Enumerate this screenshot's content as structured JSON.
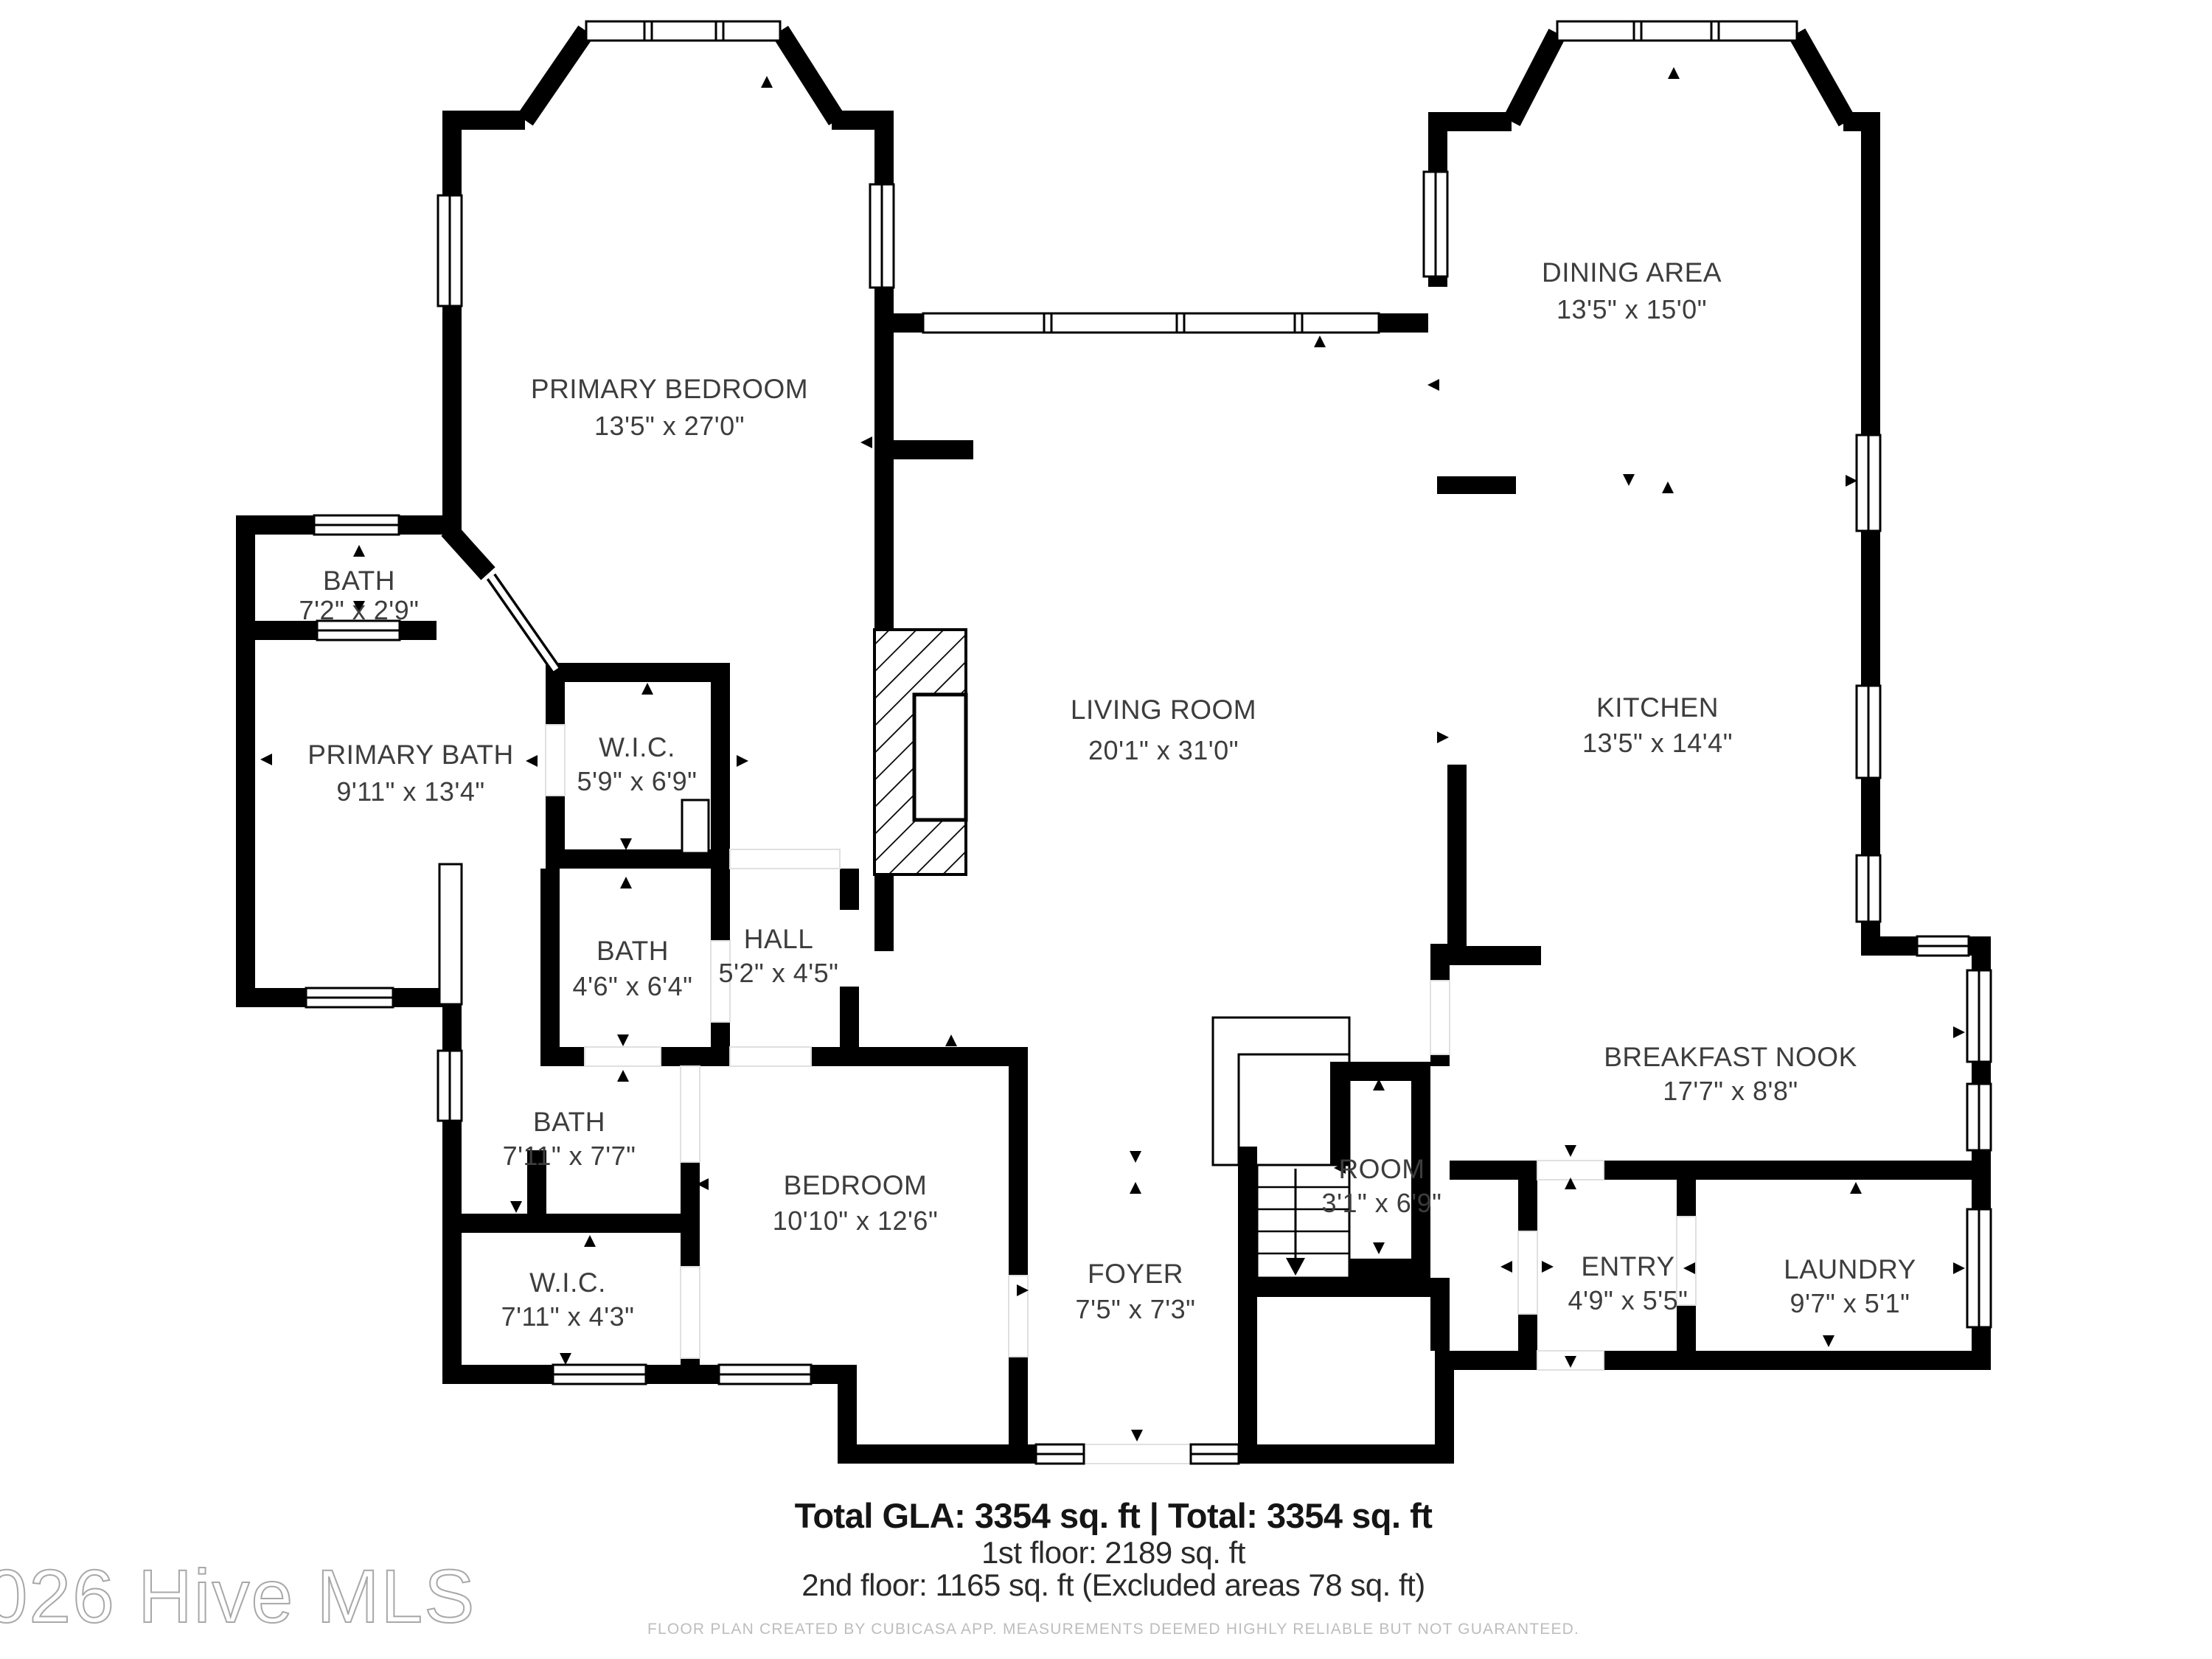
{
  "floor_plan": {
    "creator_note": "FLOOR PLAN CREATED BY CUBICASA APP. MEASUREMENTS DEEMED HIGHLY RELIABLE BUT NOT GUARANTEED.",
    "watermark": "©2026 Hive MLS",
    "totals": {
      "total_line": "Total GLA: 3354 sq. ft | Total: 3354 sq. ft",
      "floor1_line": "1st floor: 2189 sq. ft",
      "floor2_line": "2nd floor: 1165 sq. ft (Excluded areas 78 sq. ft)"
    },
    "colors": {
      "wall": "#000000",
      "label_text": "#3d3d3d",
      "footer_text": "#151515",
      "disclaimer_text": "#bdbdbd",
      "watermark_stroke": "#a8a8a8",
      "background": "#ffffff"
    },
    "rooms": [
      {
        "name": "PRIMARY BEDROOM",
        "dims": "13'5\" x 27'0\""
      },
      {
        "name": "DINING AREA",
        "dims": "13'5\" x 15'0\""
      },
      {
        "name": "BATH",
        "dims": "7'2\" x 2'9\""
      },
      {
        "name": "PRIMARY BATH",
        "dims": "9'11\" x 13'4\""
      },
      {
        "name": "W.I.C.",
        "dims": "5'9\" x 6'9\""
      },
      {
        "name": "LIVING ROOM",
        "dims": "20'1\" x 31'0\""
      },
      {
        "name": "KITCHEN",
        "dims": "13'5\" x 14'4\""
      },
      {
        "name": "BATH",
        "dims": "4'6\" x 6'4\""
      },
      {
        "name": "HALL",
        "dims": "5'2\" x 4'5\""
      },
      {
        "name": "BATH",
        "dims": "7'11\" x 7'7\""
      },
      {
        "name": "W.I.C.",
        "dims": "7'11\" x 4'3\""
      },
      {
        "name": "BEDROOM",
        "dims": "10'10\" x 12'6\""
      },
      {
        "name": "FOYER",
        "dims": "7'5\" x 7'3\""
      },
      {
        "name": "ROOM",
        "dims": "3'1\" x 6'9\""
      },
      {
        "name": "BREAKFAST NOOK",
        "dims": "17'7\" x 8'8\""
      },
      {
        "name": "ENTRY",
        "dims": "4'9\" x 5'5\""
      },
      {
        "name": "LAUNDRY",
        "dims": "9'7\" x 5'1\""
      }
    ]
  }
}
